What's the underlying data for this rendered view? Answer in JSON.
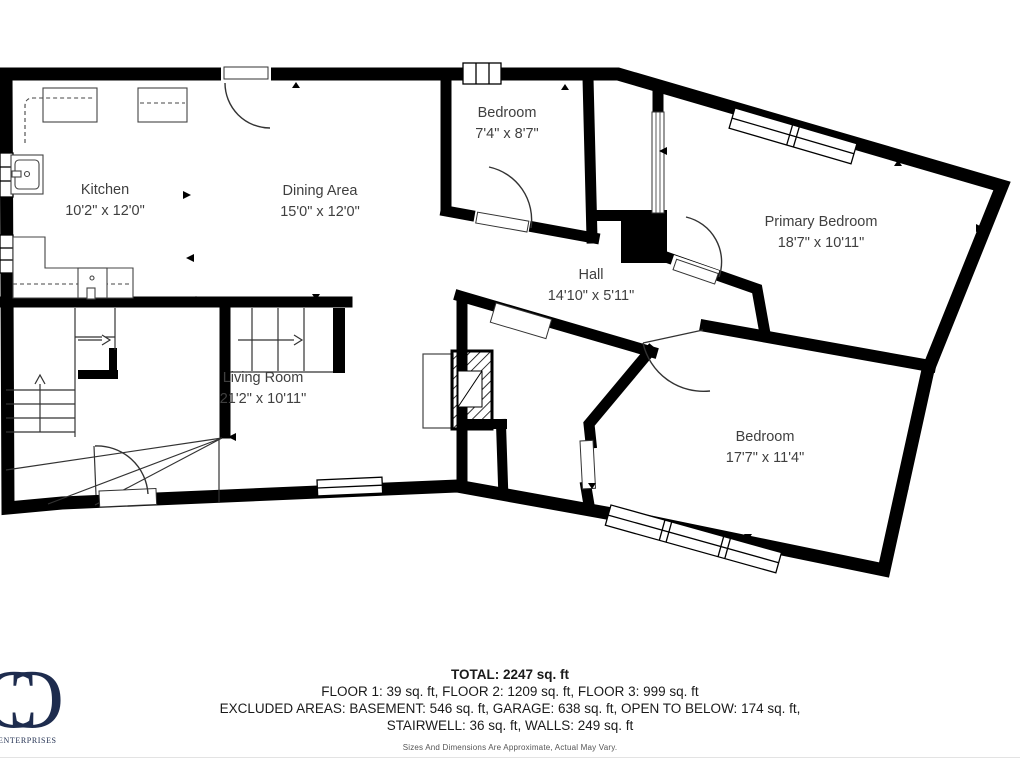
{
  "rooms": [
    {
      "name": "Kitchen",
      "dims": "10'2\" x 12'0\""
    },
    {
      "name": "Dining Area",
      "dims": "15'0\" x 12'0\""
    },
    {
      "name": "Bedroom",
      "dims": "7'4\" x 8'7\""
    },
    {
      "name": "Primary Bedroom",
      "dims": "18'7\" x 10'11\""
    },
    {
      "name": "Hall",
      "dims": "14'10\" x 5'11\""
    },
    {
      "name": "Living Room",
      "dims": "21'2\" x 10'11\""
    },
    {
      "name": "Bedroom",
      "dims": "17'7\" x 11'4\""
    }
  ],
  "summary": {
    "total_line": "TOTAL: 2247 sq. ft",
    "floors_line": "FLOOR 1: 39 sq. ft, FLOOR 2: 1209 sq. ft, FLOOR 3: 999 sq. ft",
    "excluded_line1": "EXCLUDED AREAS: BASEMENT: 546 sq. ft, GARAGE: 638 sq. ft, OPEN TO BELOW: 174 sq. ft,",
    "excluded_line2": "STAIRWELL: 36 sq. ft, WALLS: 249 sq. ft",
    "disclaimer": "Sizes And Dimensions Are Approximate, Actual May Vary."
  },
  "logo": {
    "monogram_letter": "C",
    "text": "ENTERPRISES",
    "color": "#1e2c4e"
  },
  "colors": {
    "wall": "#000000",
    "label_text": "#3f3f3f",
    "summary_text": "#1a1a1a",
    "background": "#ffffff"
  }
}
